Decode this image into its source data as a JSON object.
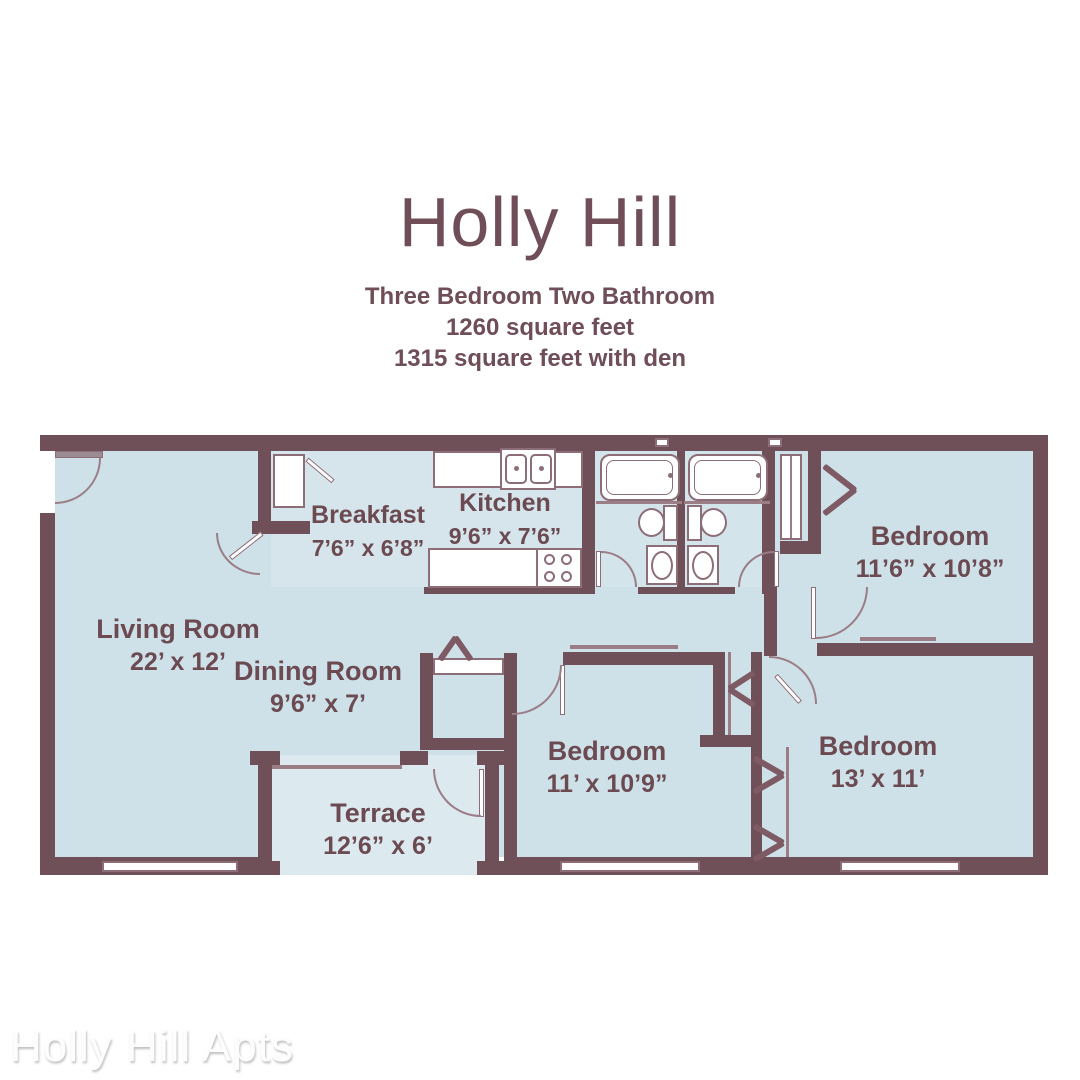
{
  "header": {
    "title": "Holly Hill",
    "subtitle_line1": "Three Bedroom Two Bathroom",
    "subtitle_line2": "1260 square feet",
    "subtitle_line3": "1315 square feet with den"
  },
  "watermark": "Holly Hill Apts",
  "rooms": {
    "living": {
      "name": "Living Room",
      "dims": "22’ x 12’"
    },
    "breakfast": {
      "name": "Breakfast",
      "dims": "7’6” x 6’8”"
    },
    "kitchen": {
      "name": "Kitchen",
      "dims": "9’6” x 7’6”"
    },
    "bedroom1": {
      "name": "Bedroom",
      "dims": "11’6” x 10’8”"
    },
    "dining": {
      "name": "Dining Room",
      "dims": "9’6” x 7’"
    },
    "bedroom2": {
      "name": "Bedroom",
      "dims": "11’ x 10’9”"
    },
    "bedroom3": {
      "name": "Bedroom",
      "dims": "13’ x 11’"
    },
    "terrace": {
      "name": "Terrace",
      "dims": "12’6” x 6’"
    }
  },
  "colors": {
    "wall": "#6f4f58",
    "floor": "#cfe1e8",
    "terrace_floor": "#dceaef",
    "fixture_outline": "#8d6e78",
    "label_text": "#6b4a52",
    "background": "#ffffff"
  }
}
